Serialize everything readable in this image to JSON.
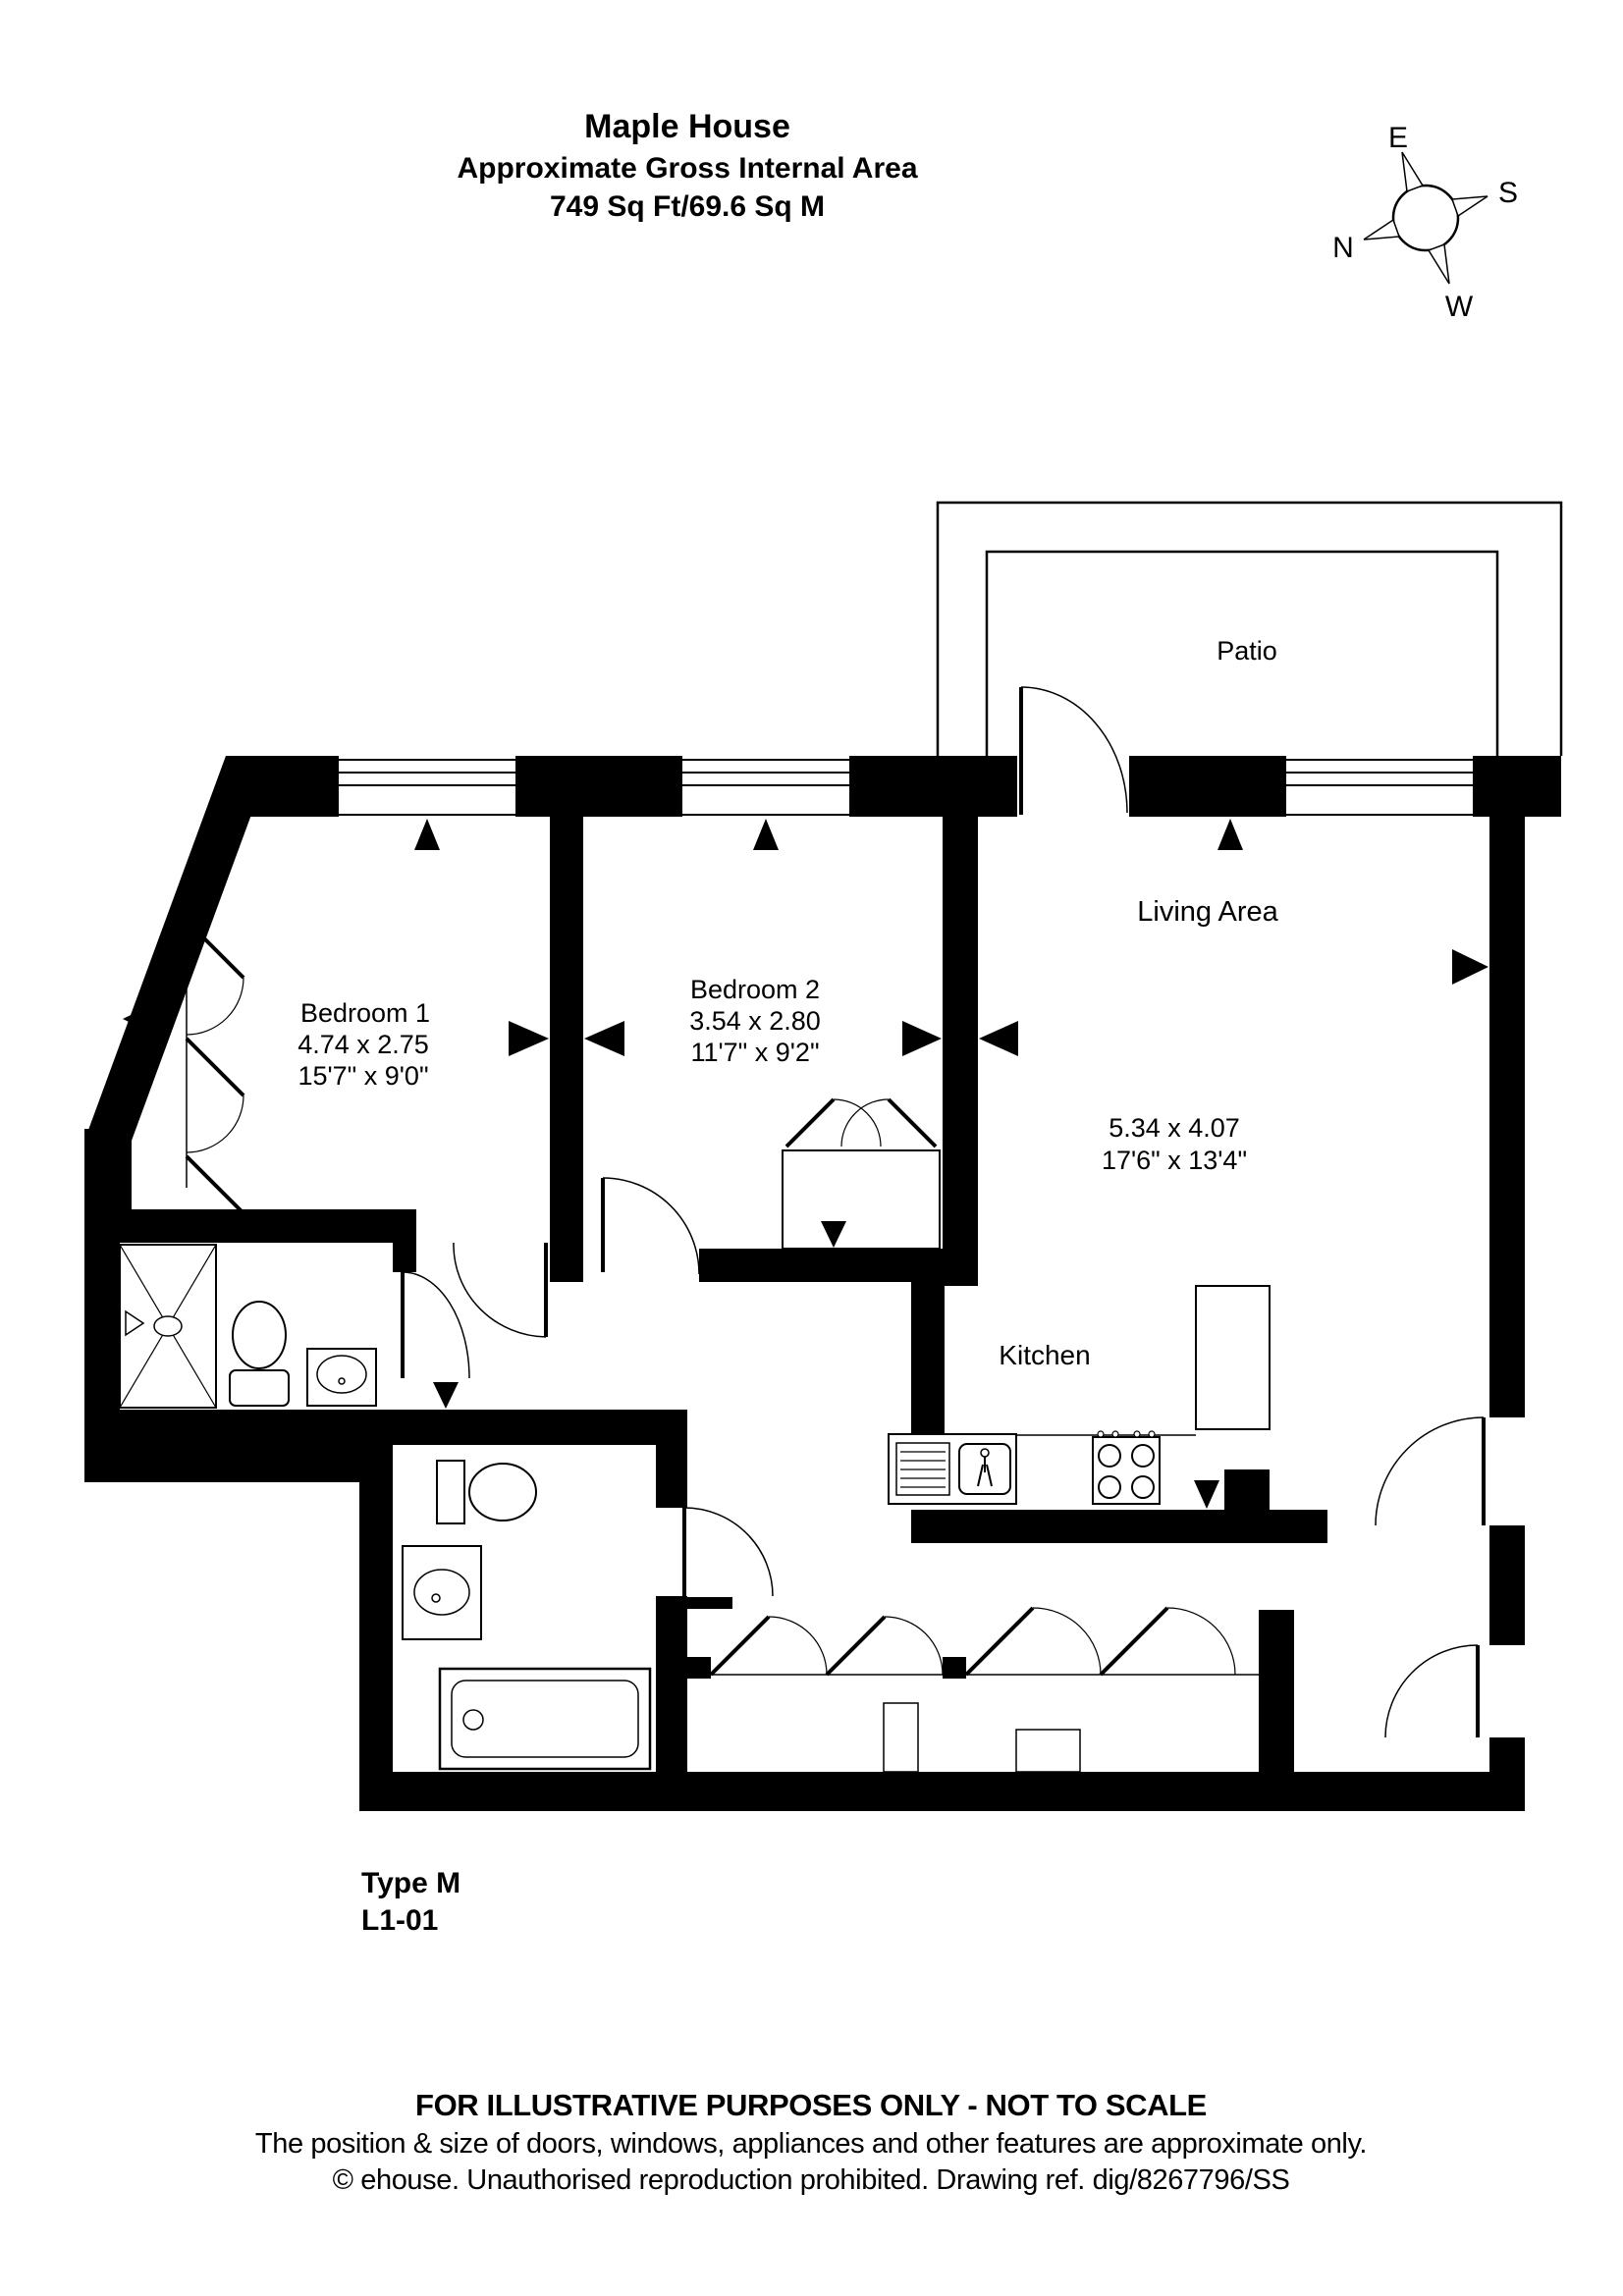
{
  "header": {
    "title": "Maple House",
    "subtitle": "Approximate Gross Internal Area",
    "area": "749 Sq Ft/69.6 Sq M"
  },
  "compass": {
    "north": "N",
    "east": "E",
    "south": "S",
    "west": "W"
  },
  "rooms": {
    "patio": {
      "name": "Patio"
    },
    "living": {
      "name": "Living Area",
      "metric": "5.34 x 4.07",
      "imperial": "17'6\" x 13'4\""
    },
    "kitchen": {
      "name": "Kitchen"
    },
    "bedroom1": {
      "name": "Bedroom 1",
      "metric": "4.74 x 2.75",
      "imperial": "15'7\" x 9'0\""
    },
    "bedroom2": {
      "name": "Bedroom 2",
      "metric": "3.54 x 2.80",
      "imperial": "11'7\" x 9'2\""
    }
  },
  "unit": {
    "type": "Type M",
    "number": "L1-01"
  },
  "footer": {
    "line1": "FOR ILLUSTRATIVE PURPOSES ONLY - NOT TO SCALE",
    "line2": "The position & size of doors, windows, appliances and other features are approximate only.",
    "line3": "© ehouse. Unauthorised reproduction prohibited. Drawing ref. dig/8267796/SS"
  },
  "colors": {
    "ink": "#000000",
    "paper": "#ffffff"
  }
}
